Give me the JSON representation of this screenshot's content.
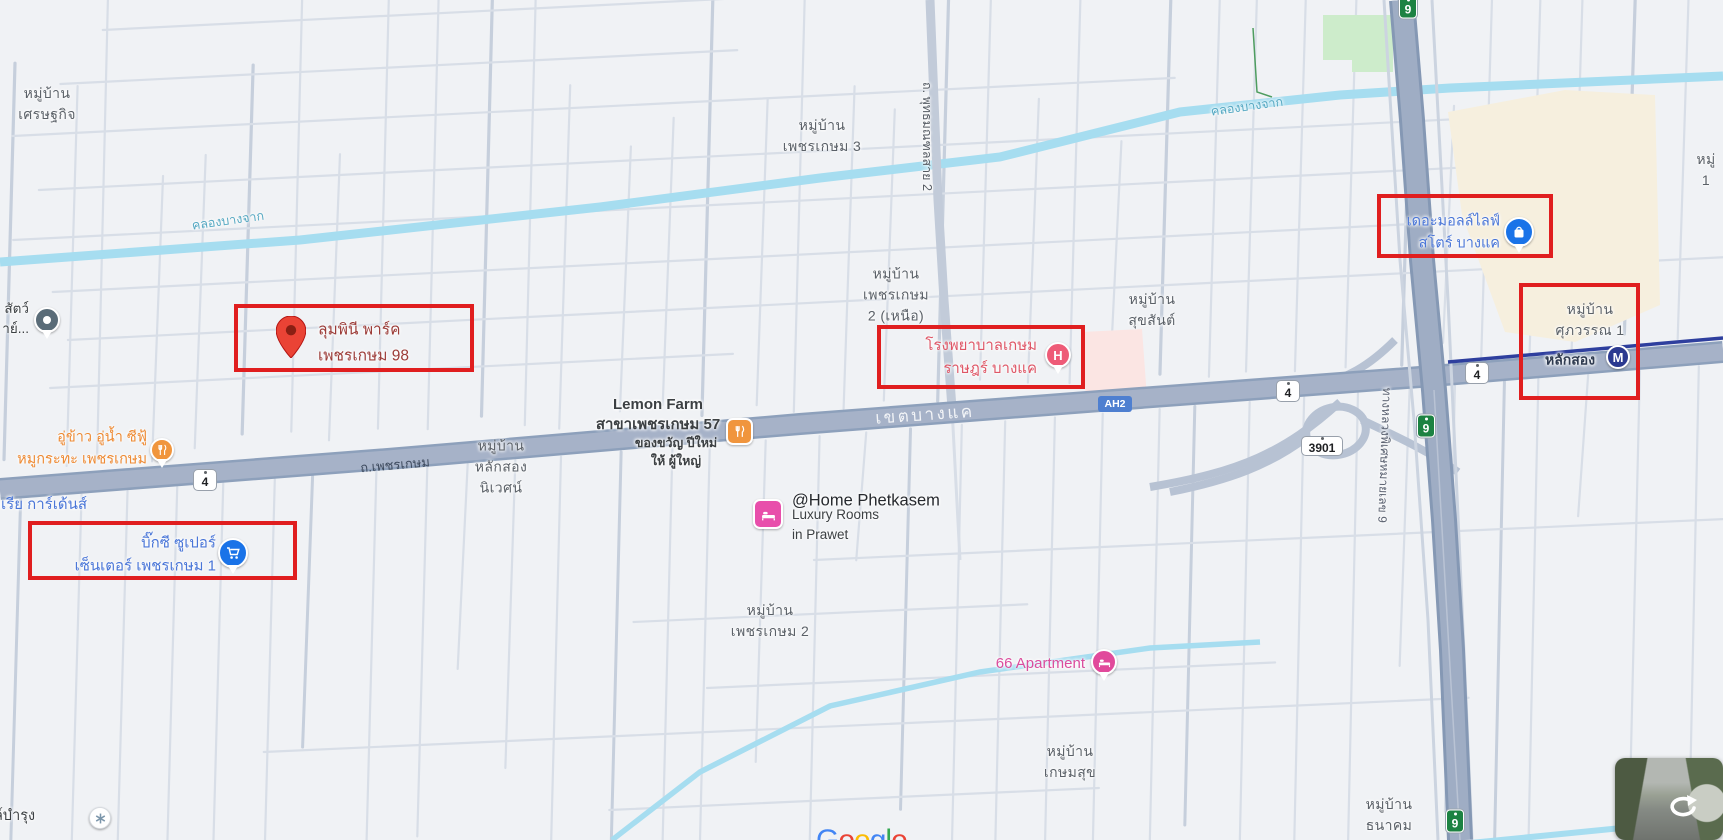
{
  "colors": {
    "annotation_red": "#e01e1f",
    "poi_blue": "#4a76d8",
    "poi_orange": "#ee8a33",
    "poi_pink_red": "#df5666",
    "poi_magenta": "#db4d9d",
    "poi_dark_red": "#9c3c38",
    "metro_line": "#2e3f9e",
    "google_logo": [
      "#4285F4",
      "#EA4335",
      "#FBBC05",
      "#4285F4",
      "#34A853",
      "#EA4335"
    ]
  },
  "map": {
    "attribution": "Google",
    "district_label": "เขตบางแค",
    "road_labels": {
      "phetkasem": "ถ.เพชรเกษม",
      "phutthamonthon_sai2": "ถ. พุทธมณฑลสาย 2",
      "motorway9": "ทางหลวงพิเศษหมายเลข 9"
    },
    "canal_label": "คลองบางจาก",
    "route_shields": {
      "r4": "4",
      "r3901": "3901",
      "r9": "9",
      "ah2": "AH2"
    },
    "metro_station": {
      "name": "หลักสอง",
      "m": "M"
    },
    "localities": {
      "sethakit": "หมู่บ้าน\nเศรษฐกิจ",
      "phetkasem3": "หมู่บ้าน\nเพชรเกษม 3",
      "phetkasem2_nuea": "หมู่บ้าน\nเพชรเกษม\n2 (เหนือ)",
      "suksan": "หมู่บ้าน\nสุขสันต์",
      "supawan1": "หมู่บ้าน\nศุภวรรณ 1",
      "laksong_nives": "หมู่บ้าน\nหลักสอง\nนิเวศน์",
      "phetkasem2": "หมู่บ้าน\nเพชรเกษม 2",
      "kasemsuk": "หมู่บ้าน\nเกษมสุข",
      "thanakhom": "หมู่บ้าน\nธนาคม",
      "mu1": "หมู่ 1"
    },
    "pois": {
      "lumpini": {
        "name": "ลุมพินี พาร์ค\nเพชรเกษม 98"
      },
      "kasemrad_hospital": {
        "name": "โรงพยาบาลเกษม\nราษฎร์ บางแค",
        "h": "H"
      },
      "the_mall": {
        "name": "เดอะมอลล์ไลฟ์\nสโตร์ บางแค"
      },
      "big_c": {
        "name": "บิ๊กซี ซูเปอร์\nเซ็นเตอร์ เพชรเกษม 1"
      },
      "lemon_farm": {
        "name": "Lemon Farm\nสาขาเพชรเกษม 57",
        "subtitle": "ของขวัญ ปีใหม่\nให้ ผู้ใหญ่"
      },
      "at_home": {
        "name": "@Home Phetkasem",
        "subtitle": "Luxury Rooms\nin Prawet"
      },
      "apartment66": {
        "name": "66 Apartment"
      },
      "uu_khao": {
        "name": "อู่ข้าว อู่น้ำ ซีฟู้\nหมูกระทะ เพชรเกษม"
      },
      "animal_truncated": {
        "name": "สัตว์\nาย์..."
      },
      "gardens_truncated": {
        "name": "อเรีย การ์เด้นส์"
      },
      "bamrung_truncated": {
        "name": "ล์บำรุง"
      }
    }
  }
}
